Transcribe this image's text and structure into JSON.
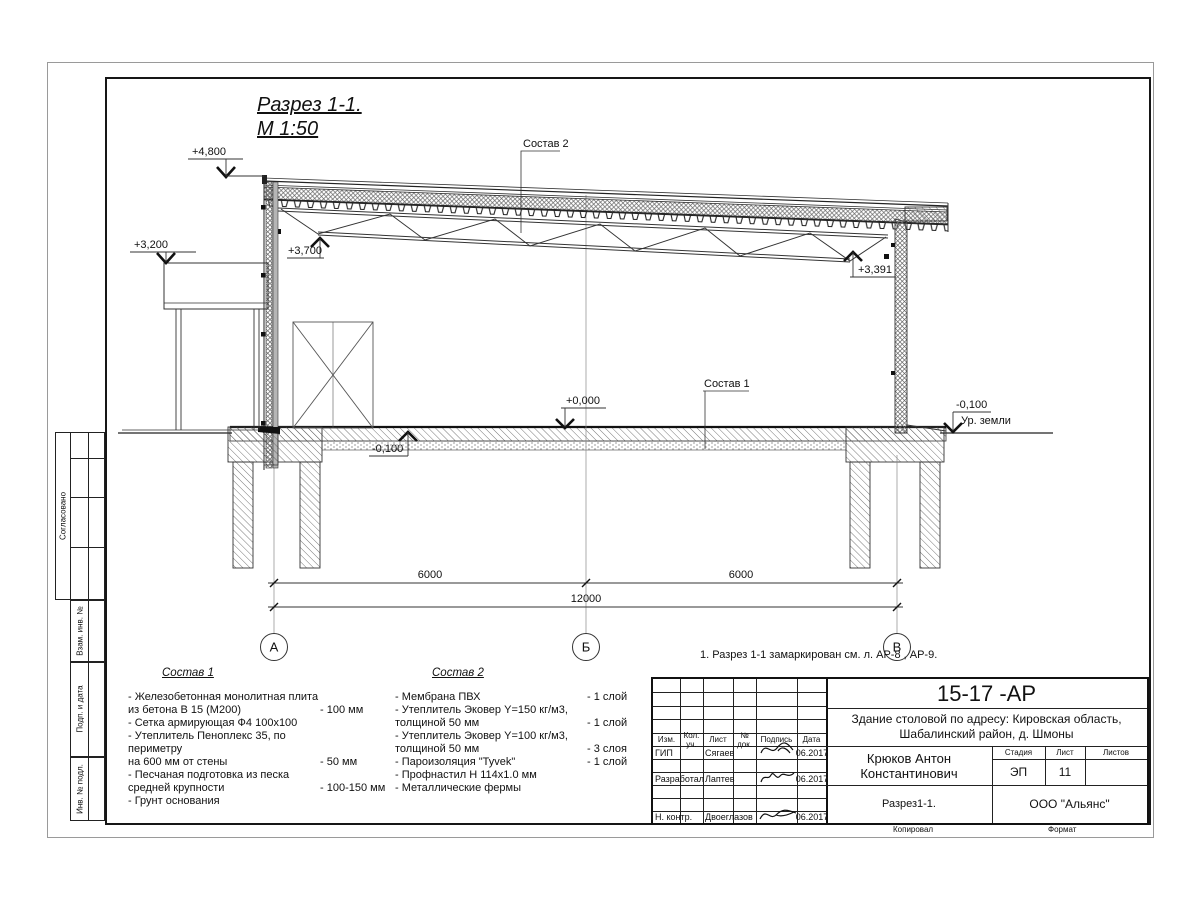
{
  "drawing": {
    "title_line1": "Разрез 1-1.",
    "title_line2": "М 1:50",
    "elevations": {
      "e4800": "+4,800",
      "e3200": "+3,200",
      "e3700": "+3,700",
      "e3391": "+3,391",
      "e0000": "+0,000",
      "em0100_left": "-0,100",
      "em0100_right": "-0,100",
      "ground_label": "Ур. земли"
    },
    "leaders": {
      "sostav1_ref": "Состав 1",
      "sostav2_ref": "Состав 2"
    },
    "dimensions": {
      "span1": "6000",
      "span2": "6000",
      "total": "12000"
    },
    "axes": [
      "А",
      "Б",
      "В"
    ],
    "note": "1. Разрез 1-1 замаркирован см. л. АР-8 , АР-9."
  },
  "sostav1": {
    "title": "Состав 1",
    "items": [
      {
        "text": "- Железобетонная  монолитная плита\n  из бетона В 15 (М200)",
        "value": "- 100 мм"
      },
      {
        "text": "- Сетка армирующая Ф4 100х100",
        "value": ""
      },
      {
        "text": "- Утеплитель Пеноплекс 35, по периметру\n  на 600 мм от стены",
        "value": "- 50 мм"
      },
      {
        "text": "- Песчаная подготовка из песка\n  средней крупности",
        "value": "- 100-150 мм"
      },
      {
        "text": "- Грунт основания",
        "value": ""
      }
    ]
  },
  "sostav2": {
    "title": "Состав 2",
    "items": [
      {
        "text": "- Мембрана ПВХ",
        "value": "- 1 слой"
      },
      {
        "text": "- Утеплитель Эковер Y=150 кг/м3,\n  толщиной 50 мм",
        "value": "- 1 слой"
      },
      {
        "text": "- Утеплитель Эковер Y=100 кг/м3,\n  толщиной 50 мм",
        "value": "- 3 слоя"
      },
      {
        "text": "- Пароизоляция \"Tyvek\"",
        "value": "- 1 слой"
      },
      {
        "text": "- Профнастил Н 114х1.0 мм",
        "value": ""
      },
      {
        "text": "- Металлические фермы",
        "value": ""
      }
    ]
  },
  "side_strip": {
    "agreed": "Согласовано",
    "vzam": "Взам. инв. №",
    "podp": "Подп. и дата",
    "inv": "Инв. № подл."
  },
  "title_block": {
    "doc_number": "15-17 -АР",
    "project_line1": "Здание столовой по адресу: Кировская область,",
    "project_line2": "Шабалинский район, д. Шмоны",
    "author": "Крюков Антон Константинович",
    "sheet_name": "Разрез1-1.",
    "company": "ООО \"Альянс\"",
    "stage_label": "Стадия",
    "sheet_label": "Лист",
    "sheets_label": "Листов",
    "stage": "ЭП",
    "sheet_no": "11",
    "cols": [
      "Изм.",
      "Кол. уч.",
      "Лист",
      "№ док.",
      "Подпись",
      "Дата"
    ],
    "rows": [
      {
        "role": "ГИП",
        "name": "Сягаев",
        "date": "06.2017"
      },
      {
        "role": "Разработал",
        "name": "Лаптев",
        "date": "06.2017"
      },
      {
        "role": "Н. контр.",
        "name": "Двоеглазов",
        "date": "06.2017"
      }
    ],
    "copied_label": "Копировал",
    "format_label": "Формат"
  }
}
